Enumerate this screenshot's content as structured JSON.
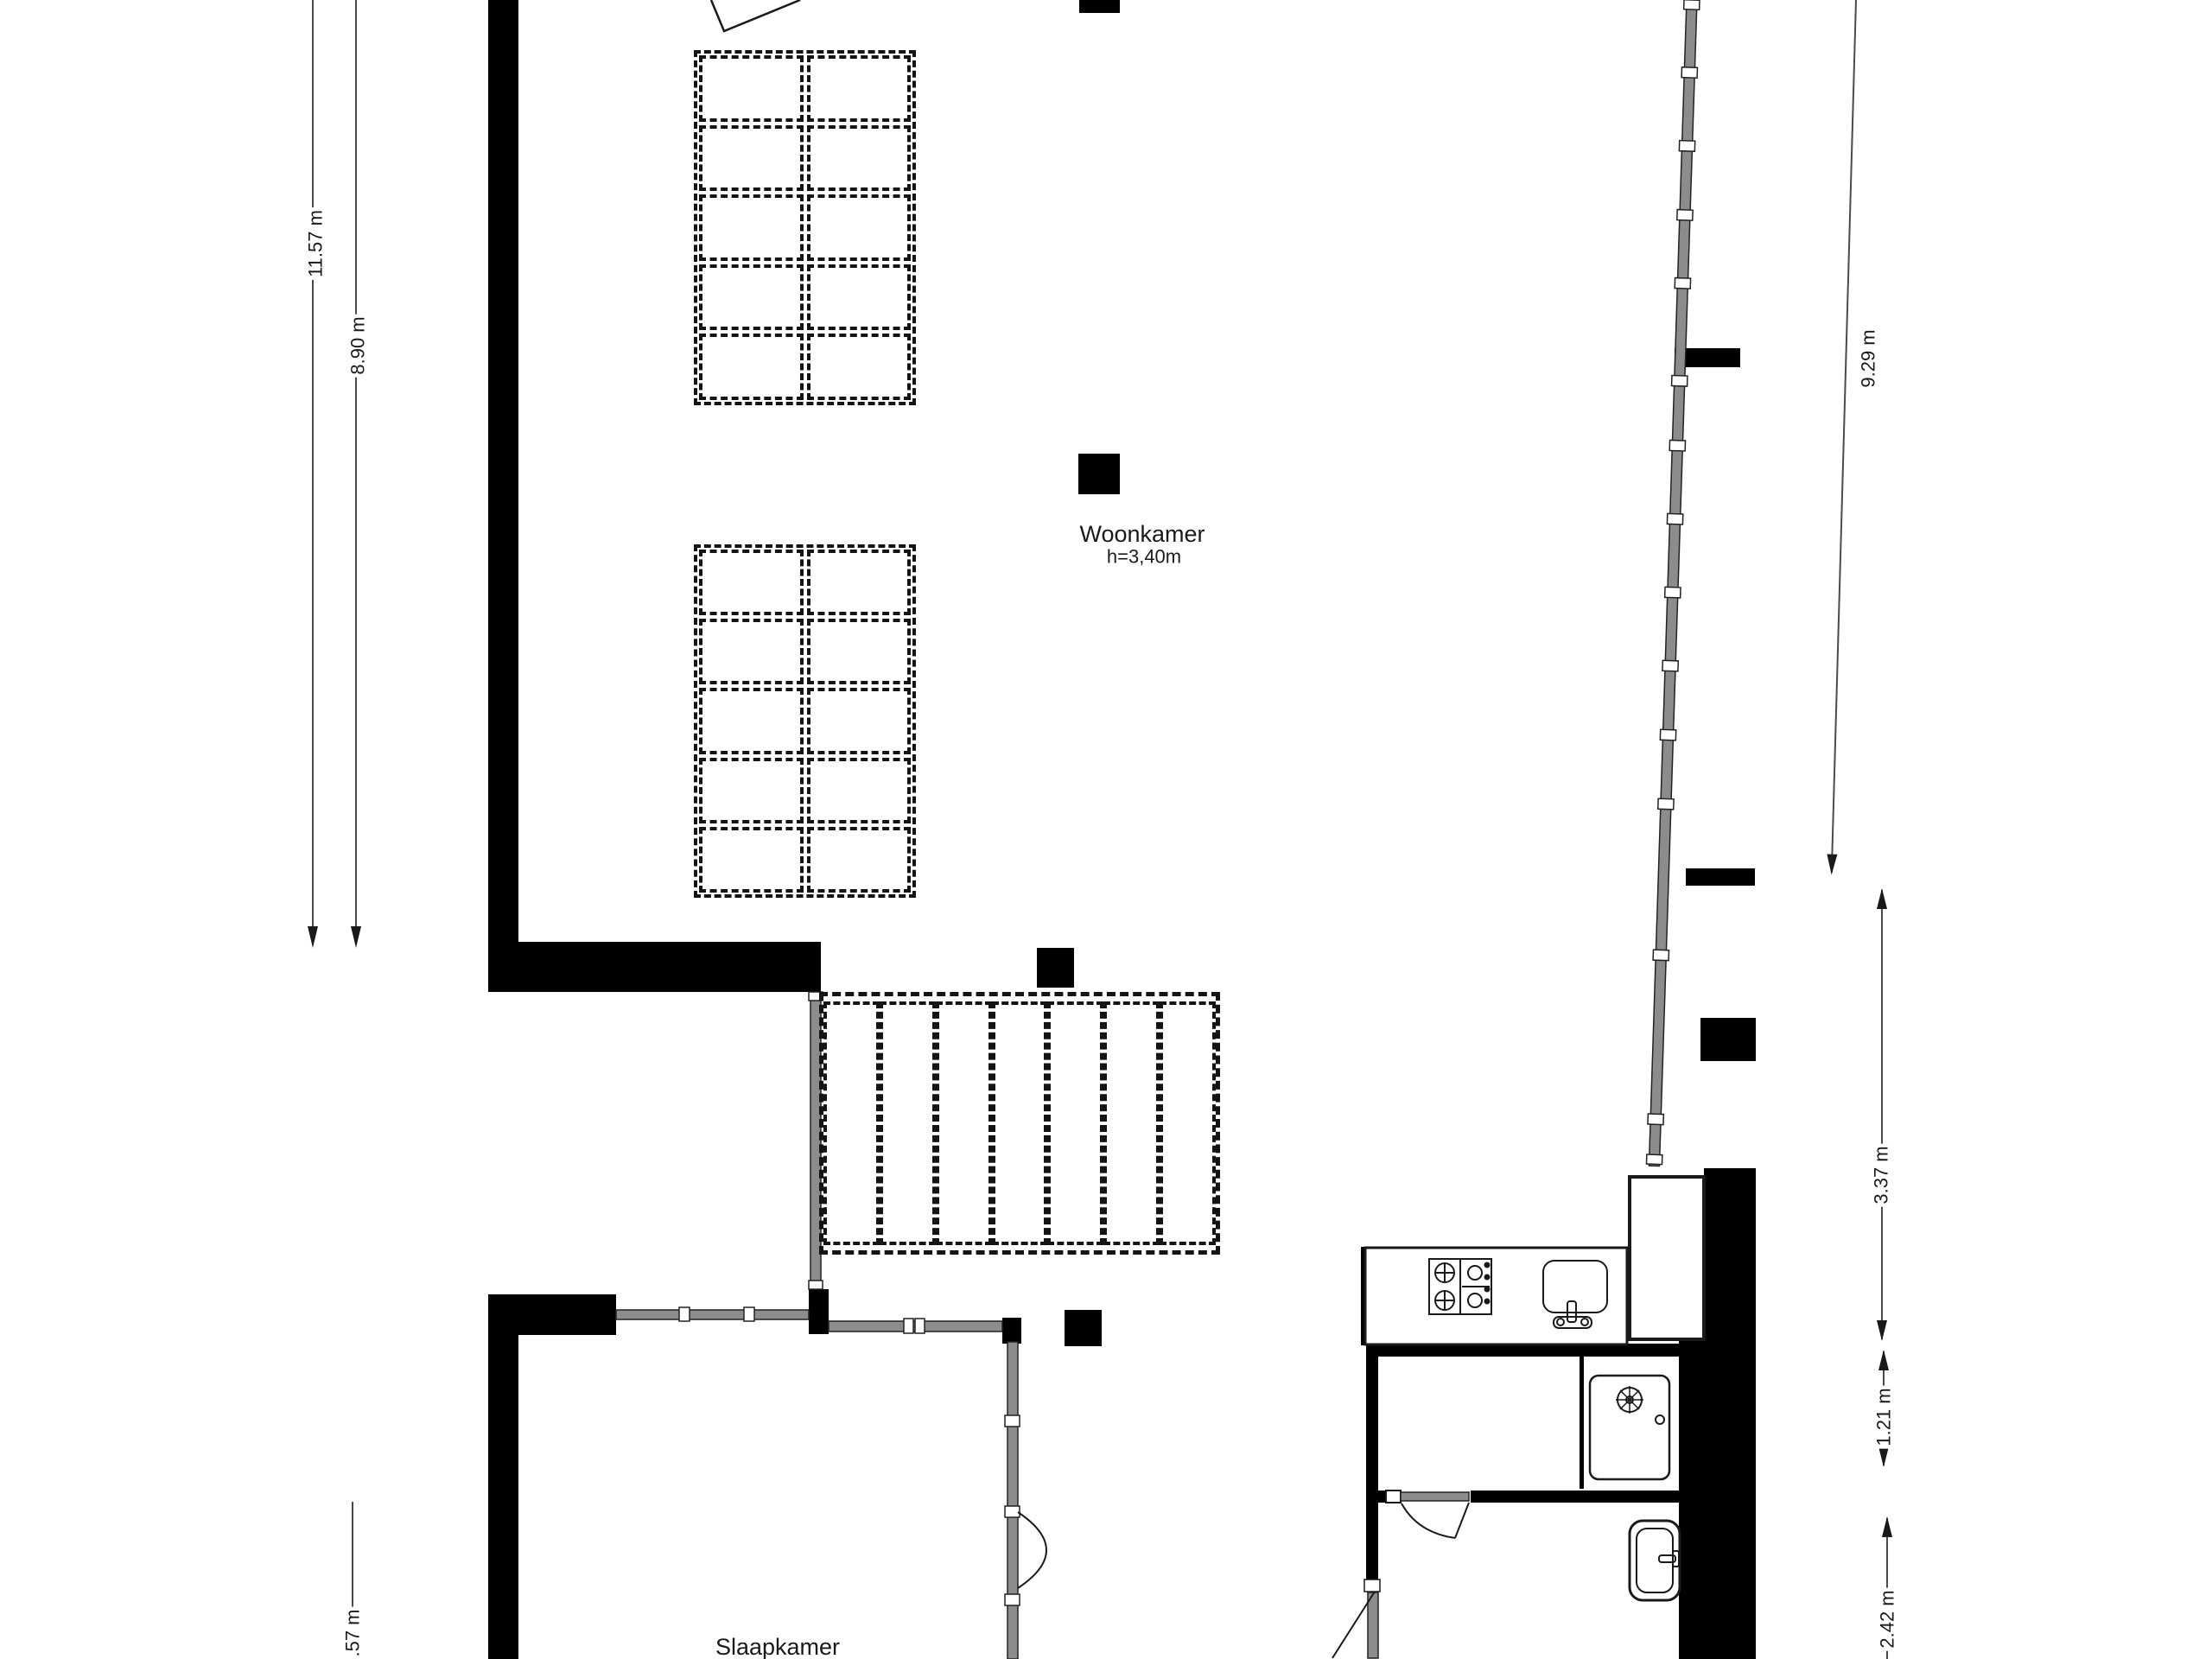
{
  "floorplan": {
    "rooms": {
      "woonkamer": {
        "name": "Woonkamer",
        "height_label": "h=3,40m"
      },
      "slaapkamer": {
        "name": "Slaapkamer"
      }
    },
    "dimensions": {
      "left": [
        "11.57 m",
        "8.90 m"
      ],
      "bottom_left": ".57 m",
      "right": [
        "9.29 m",
        "3.37 m",
        "1.21 m",
        "2.42 m"
      ]
    },
    "fixtures": [
      "gas-hob",
      "kitchen-sink",
      "shower",
      "washbasin"
    ],
    "colors": {
      "wall": "#000000",
      "glass": "#8c8c8c",
      "dash": "#141414",
      "dimension_line": "#4a4a4a",
      "background": "#ffffff"
    }
  }
}
